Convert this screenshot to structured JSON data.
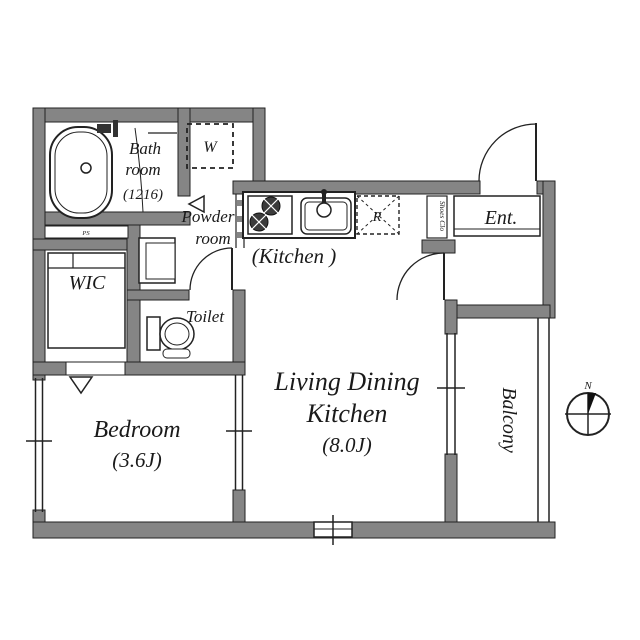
{
  "colors": {
    "background": "#ffffff",
    "wall": "#858585",
    "line": "#222222",
    "text": "#1a1a1a"
  },
  "plan": {
    "bathroom": {
      "l1": "Bath",
      "l2": "room",
      "l3": "(1216)"
    },
    "washer": "W",
    "powder": {
      "l1": "Powder",
      "l2": "room"
    },
    "ps": "PS",
    "wic": "WIC",
    "toilet": "Toilet",
    "kitchen": "(Kitchen )",
    "fridge": "R",
    "shoes_closet": "Shoes Clo",
    "entrance": "Ent.",
    "ldk": {
      "l1": "Living Dining",
      "l2": "Kitchen",
      "l3": "(8.0J)"
    },
    "bedroom": {
      "l1": "Bedroom",
      "l2": "(3.6J)"
    },
    "balcony": "Balcony",
    "compass": {
      "north": "N"
    }
  }
}
